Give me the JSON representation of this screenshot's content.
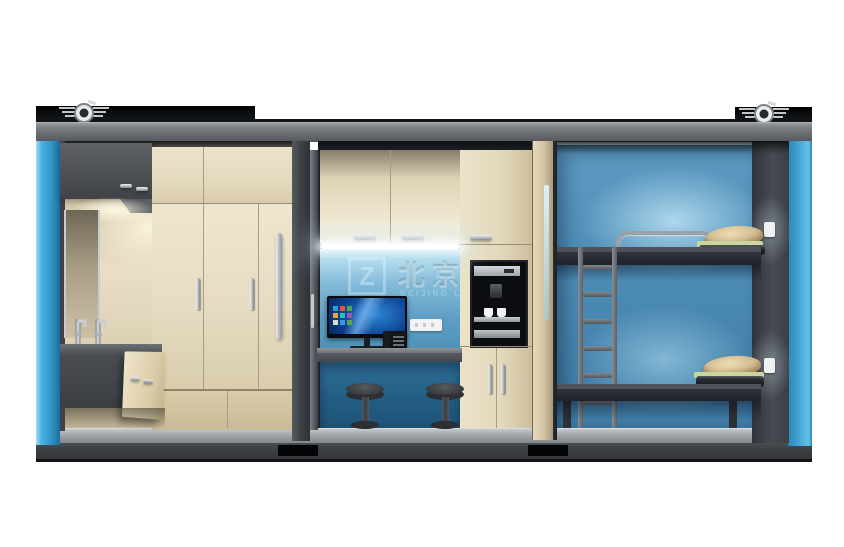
{
  "scene": {
    "type": "3d-product-render",
    "subject": "container-house cutaway with washroom, office nook and bunk bedroom",
    "background_color": "#ffffff"
  },
  "watermark": {
    "logo_glyph": "Z",
    "text_cn": "北京联",
    "text_en": "BEIJING LIANZ"
  },
  "palette": {
    "container_frame_gray": "#606367",
    "side_panel_blue": "#3da2d6",
    "cabinet_beige": "#e6dcc2",
    "office_wall_blue": "#84bcda",
    "under_desk_blue": "#245e84",
    "bedroom_wall_blue": "#4a89b2",
    "metal_silver": "#b9bdc1",
    "dark_furniture": "#33383d",
    "floor_gray": "#a4a9ad",
    "base_dark": "#33373b"
  },
  "rooms": {
    "left": {
      "name": "washroom-storage",
      "features": [
        "corner-overhead-cabinet",
        "mirror",
        "twin-faucets",
        "sink-vanity-open-door",
        "three-door-wardrobe"
      ]
    },
    "middle": {
      "name": "office-kitchenette",
      "features": [
        "three-door-upper-cabinets",
        "led-strip-light",
        "desktop-monitor-windows",
        "desk-phone",
        "wall-socket",
        "built-in-coffee-machine",
        "two-bar-stools"
      ]
    },
    "right": {
      "name": "bunk-bedroom",
      "features": [
        "two-level-bunk-bed",
        "metal-ladder",
        "guard-rail",
        "pillows-and-blankets",
        "two-light-switches"
      ]
    }
  },
  "counts": {
    "stools": 2,
    "bunk_levels": 2,
    "light_switches": 2,
    "roof_vents": 2,
    "forklift_pockets": 2,
    "wardrobe_doors": 3,
    "upper_cabinet_doors": 3
  }
}
